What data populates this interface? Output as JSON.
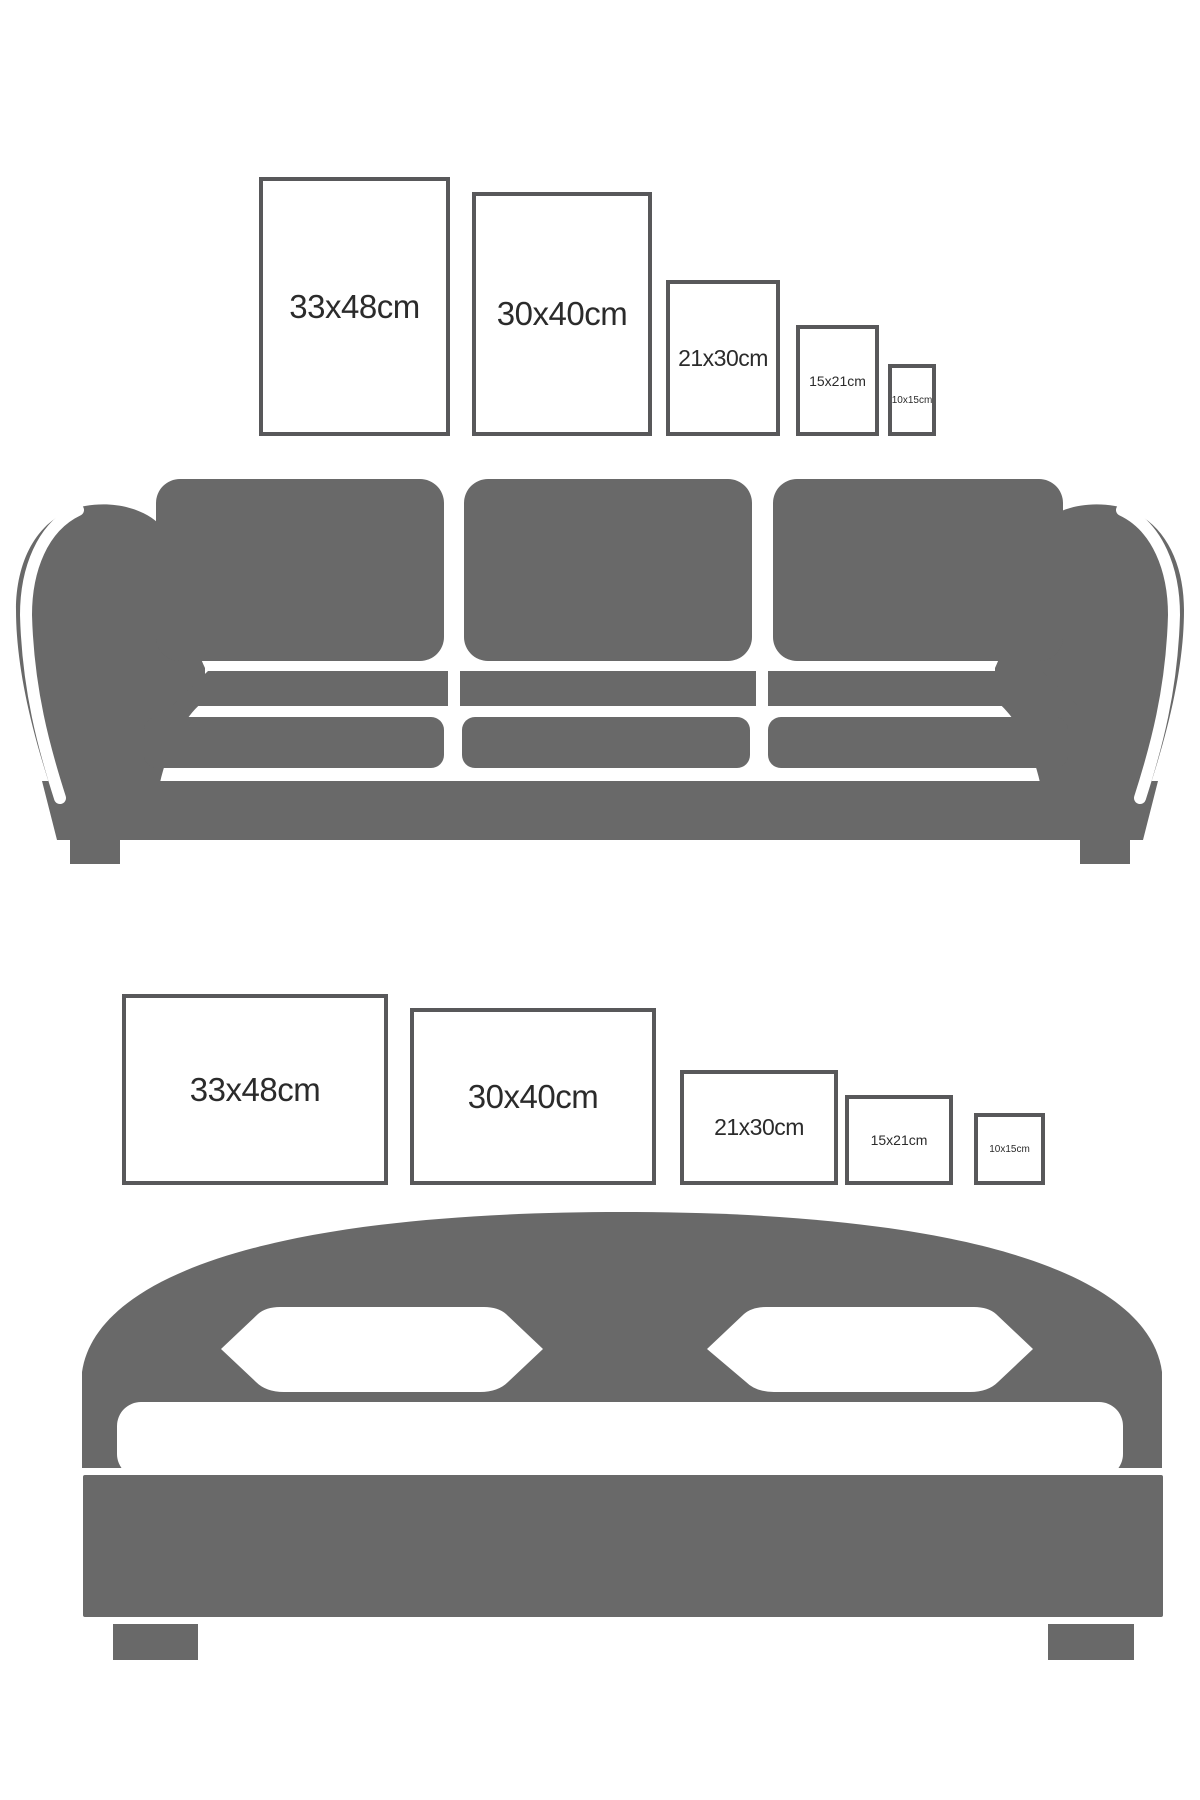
{
  "page": {
    "background": "#ffffff",
    "description_labels": []
  },
  "colors": {
    "furniture_gray": "#696969",
    "frame_border": "#58585a",
    "label_text": "#2b2b2b"
  },
  "top_section": {
    "furniture": "sofa",
    "frames": [
      {
        "label": "33x48cm",
        "width_cm": 33,
        "height_cm": 48,
        "orientation": "portrait"
      },
      {
        "label": "30x40cm",
        "width_cm": 30,
        "height_cm": 40,
        "orientation": "portrait"
      },
      {
        "label": "21x30cm",
        "width_cm": 21,
        "height_cm": 30,
        "orientation": "portrait"
      },
      {
        "label": "15x21cm",
        "width_cm": 15,
        "height_cm": 21,
        "orientation": "portrait"
      },
      {
        "label": "10x15cm",
        "width_cm": 10,
        "height_cm": 15,
        "orientation": "portrait"
      }
    ]
  },
  "bottom_section": {
    "furniture": "bed",
    "frames": [
      {
        "label": "33x48cm",
        "width_cm": 48,
        "height_cm": 33,
        "orientation": "landscape"
      },
      {
        "label": "30x40cm",
        "width_cm": 40,
        "height_cm": 30,
        "orientation": "landscape"
      },
      {
        "label": "21x30cm",
        "width_cm": 30,
        "height_cm": 21,
        "orientation": "landscape"
      },
      {
        "label": "15x21cm",
        "width_cm": 21,
        "height_cm": 15,
        "orientation": "landscape"
      },
      {
        "label": "10x15cm",
        "width_cm": 15,
        "height_cm": 10,
        "orientation": "landscape"
      }
    ]
  }
}
